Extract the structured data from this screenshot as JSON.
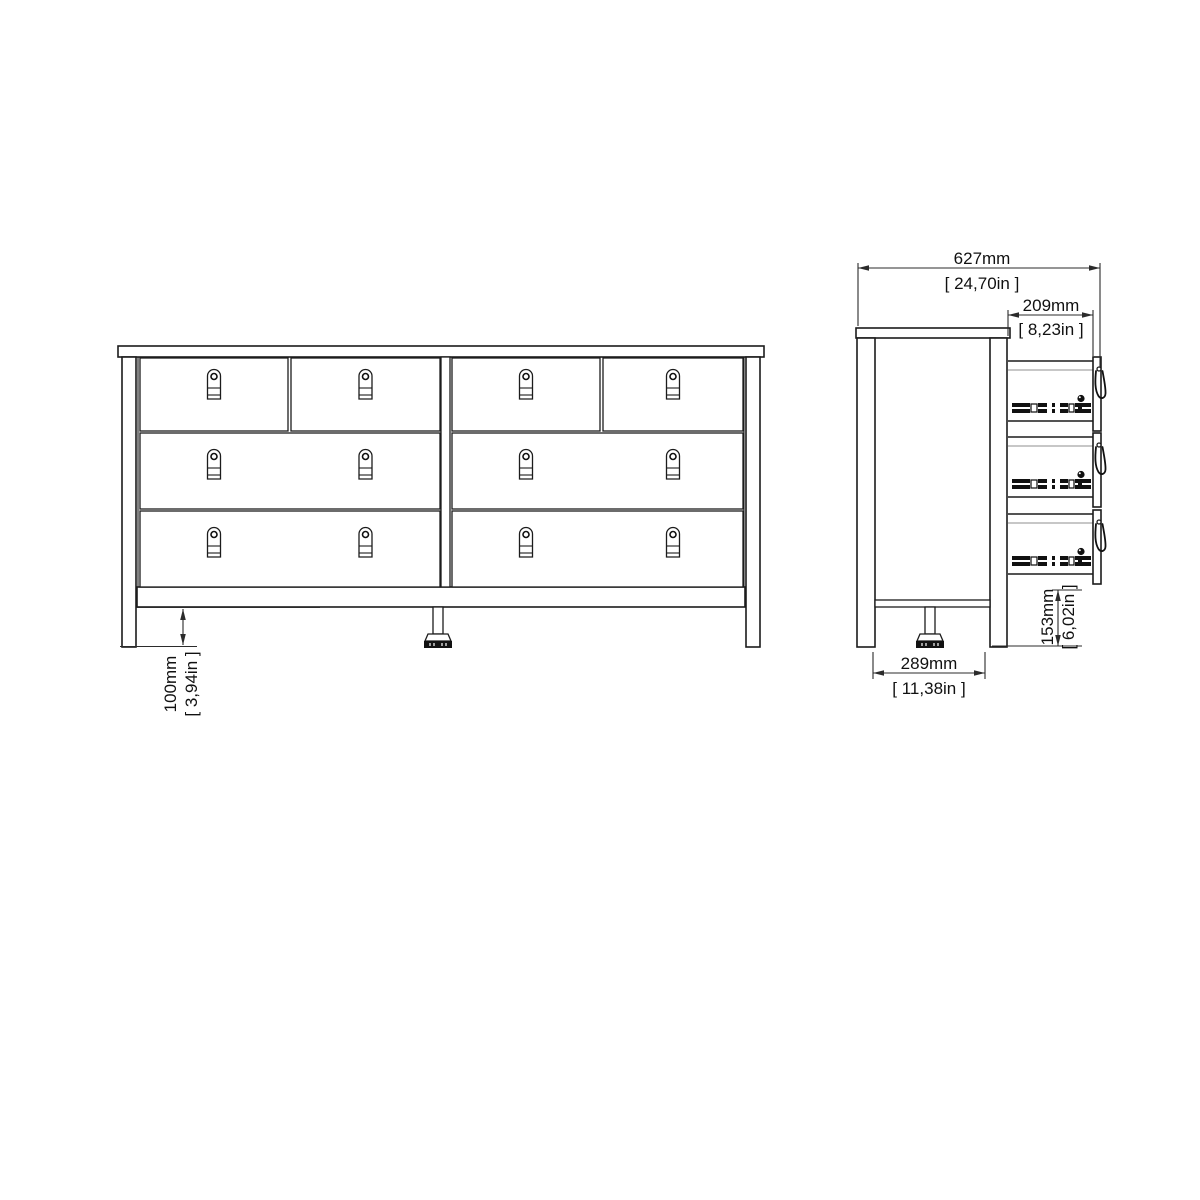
{
  "drawing": {
    "subject": "double dresser with eight drawers, front and side orthographic views",
    "background": "#ffffff"
  },
  "dimensions": {
    "open_depth": {
      "mm": "627mm",
      "in": "[ 24,70in ]"
    },
    "drawer_extension": {
      "mm": "209mm",
      "in": "[ 8,23in ]"
    },
    "body_depth": {
      "mm": "289mm",
      "in": "[ 11,38in ]"
    },
    "drawer_height": {
      "mm": "153mm",
      "in": "[ 6,02in ]"
    },
    "base_clearance": {
      "mm": "100mm",
      "in": "[ 3,94in ]"
    }
  },
  "colors": {
    "line": "#1c1c1c",
    "secondary_line": "#8f8f8f",
    "detail_fill": "#111111",
    "dimension_line": "#2b2b2b"
  }
}
